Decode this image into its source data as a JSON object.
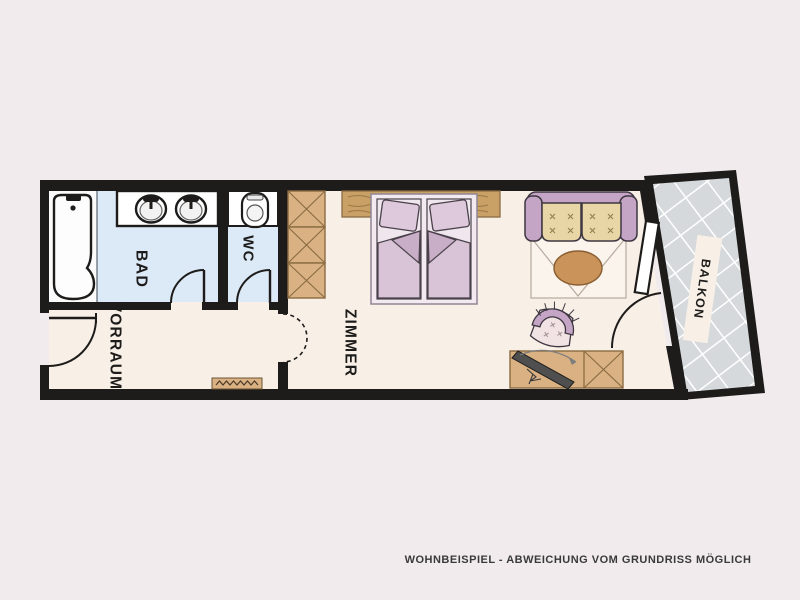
{
  "plan": {
    "rooms": {
      "bathroom_label": "BAD",
      "wc_label": "WC",
      "hallway_label": "VORRAUM",
      "bedroom_label": "ZIMMER",
      "balcony_label": "BALKON"
    },
    "caption": "WOHNBEISPIEL - ABWEICHUNG VOM GRUNDRISS MÖGLICH"
  },
  "colors": {
    "page_background": "#f1ebee",
    "floor": "#f8f0e7",
    "bath_floor": "#dce9f6",
    "wall": "#1d1c1a",
    "wood": "#d9b183",
    "wood_dark": "#c9a065",
    "mauve": "#c5a5c5",
    "bedding": "#d9c3d7",
    "pillow": "#ddc9db",
    "bed_frame": "#f2eaf0",
    "cushion": "#e9d6a7",
    "table": "#c9935a",
    "tile": "#d5d9dc",
    "tile_line": "#ffffff",
    "label": "#1d1c1a",
    "caption": "#3a3a3a"
  }
}
